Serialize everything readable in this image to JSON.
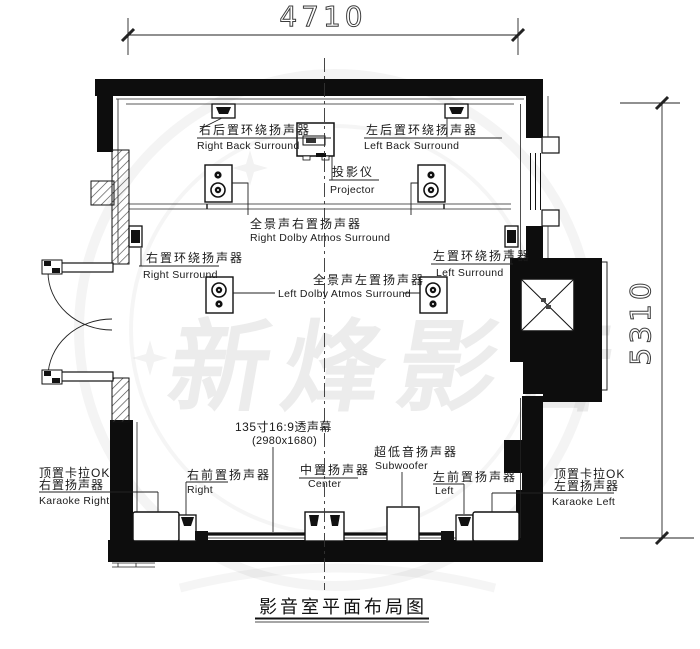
{
  "title": "影音室平面布局图",
  "dimensions": {
    "width_mm": "4710",
    "height_mm": "5310"
  },
  "watermark": "新烽影音",
  "labels": {
    "right_back_surround": {
      "zh": "右后置环绕扬声器",
      "en": "Right Back Surround"
    },
    "left_back_surround": {
      "zh": "左后置环绕扬声器",
      "en": "Left Back Surround"
    },
    "projector": {
      "zh": "投影仪",
      "en": "Projector"
    },
    "right_atmos": {
      "zh": "全景声右置扬声器",
      "en": "Right Dolby Atmos Surround"
    },
    "left_atmos": {
      "zh": "全景声左置扬声器",
      "en": "Left Dolby Atmos Surround"
    },
    "right_surround": {
      "zh": "右置环绕扬声器",
      "en": "Right Surround"
    },
    "left_surround": {
      "zh": "左置环绕扬声器",
      "en": "Left Surround"
    },
    "screen": {
      "zh": "135寸16:9透声幕",
      "size": "(2980x1680)"
    },
    "subwoofer": {
      "zh": "超低音扬声器",
      "en": "Subwoofer"
    },
    "front_right": {
      "zh": "右前置扬声器",
      "en": "Right"
    },
    "center": {
      "zh": "中置扬声器",
      "en": "Center"
    },
    "front_left": {
      "zh": "左前置扬声器",
      "en": "Left"
    },
    "karaoke_right": {
      "zh1": "顶置卡拉OK",
      "zh2": "右置扬声器",
      "en": "Karaoke Right"
    },
    "karaoke_left": {
      "zh1": "顶置卡拉OK",
      "zh2": "左置扬声器",
      "en": "Karaoke Left"
    }
  },
  "colors": {
    "wall": "#0d0d0d",
    "line": "#222222",
    "watermark_gray": "#ebebeb"
  }
}
